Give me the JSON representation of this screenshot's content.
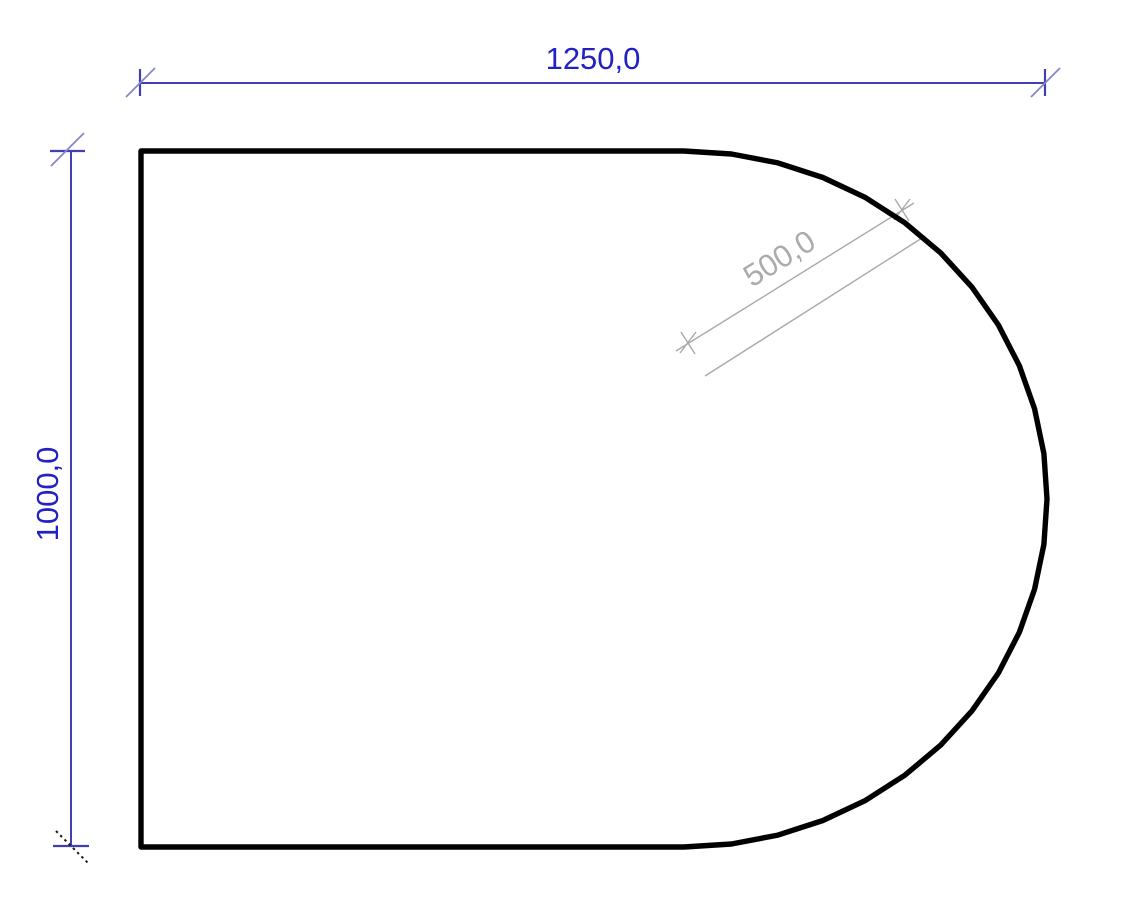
{
  "colors": {
    "background": "#ffffff",
    "outline": "#000000",
    "dim_line_blue": "#4040b0",
    "dim_slash_blue": "#8585cf",
    "dim_text_blue": "#2222c4",
    "dim_gray_line": "#a9a9a9",
    "dim_gray_text": "#ababab",
    "dim_slash_black": "#1a1a1a"
  },
  "dimensions": {
    "width": {
      "label": "1250,0"
    },
    "height": {
      "label": "1000,0"
    },
    "radius": {
      "label": "500,0"
    }
  }
}
